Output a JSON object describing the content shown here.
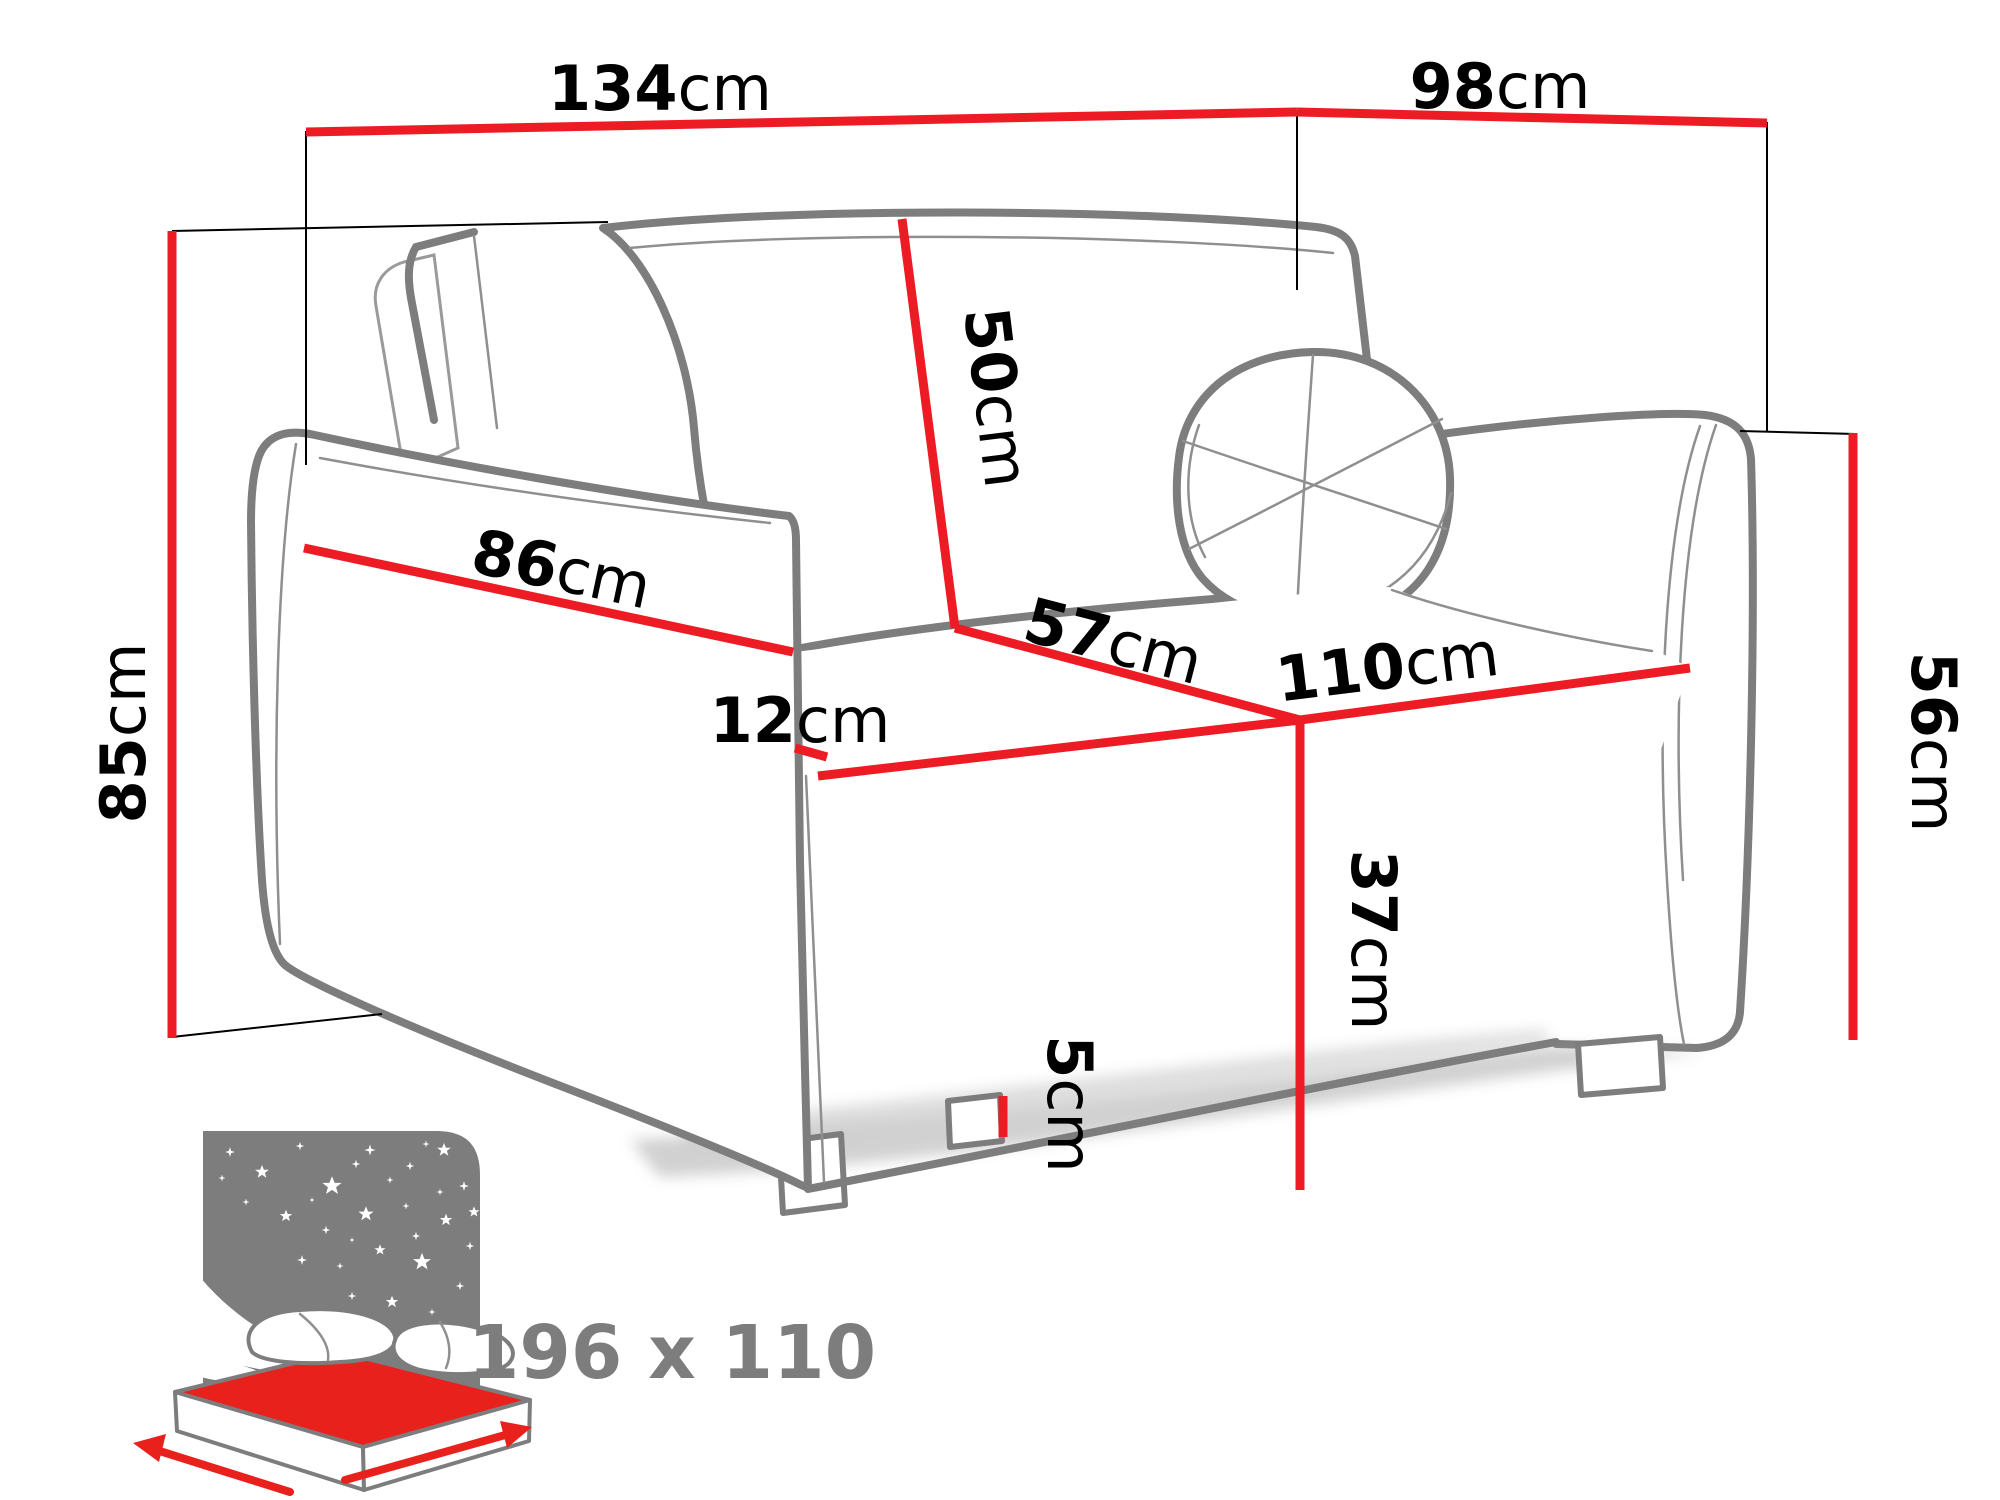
{
  "diagram": {
    "title": "sofa-bed dimension diagram",
    "colors": {
      "dimension_red": "#ed1c24",
      "outline_gray": "#7d7d7e",
      "text_black": "#000000",
      "icon_gray": "#7d7d7e",
      "mattress_red": "#e8211d",
      "background": "#ffffff"
    },
    "dimensions": {
      "width_total": {
        "value": "134",
        "unit": "cm"
      },
      "depth_total": {
        "value": "98",
        "unit": "cm"
      },
      "height_total": {
        "value": "85",
        "unit": "cm"
      },
      "backrest_height": {
        "value": "50",
        "unit": "cm"
      },
      "armrest_length": {
        "value": "86",
        "unit": "cm"
      },
      "armrest_width": {
        "value": "12",
        "unit": "cm"
      },
      "seat_depth": {
        "value": "57",
        "unit": "cm"
      },
      "seat_width": {
        "value": "110",
        "unit": "cm"
      },
      "base_height": {
        "value": "37",
        "unit": "cm"
      },
      "side_height": {
        "value": "56",
        "unit": "cm"
      },
      "leg_height": {
        "value": "5",
        "unit": "cm"
      }
    },
    "sleeping_area": {
      "label": "196 x 110"
    }
  }
}
